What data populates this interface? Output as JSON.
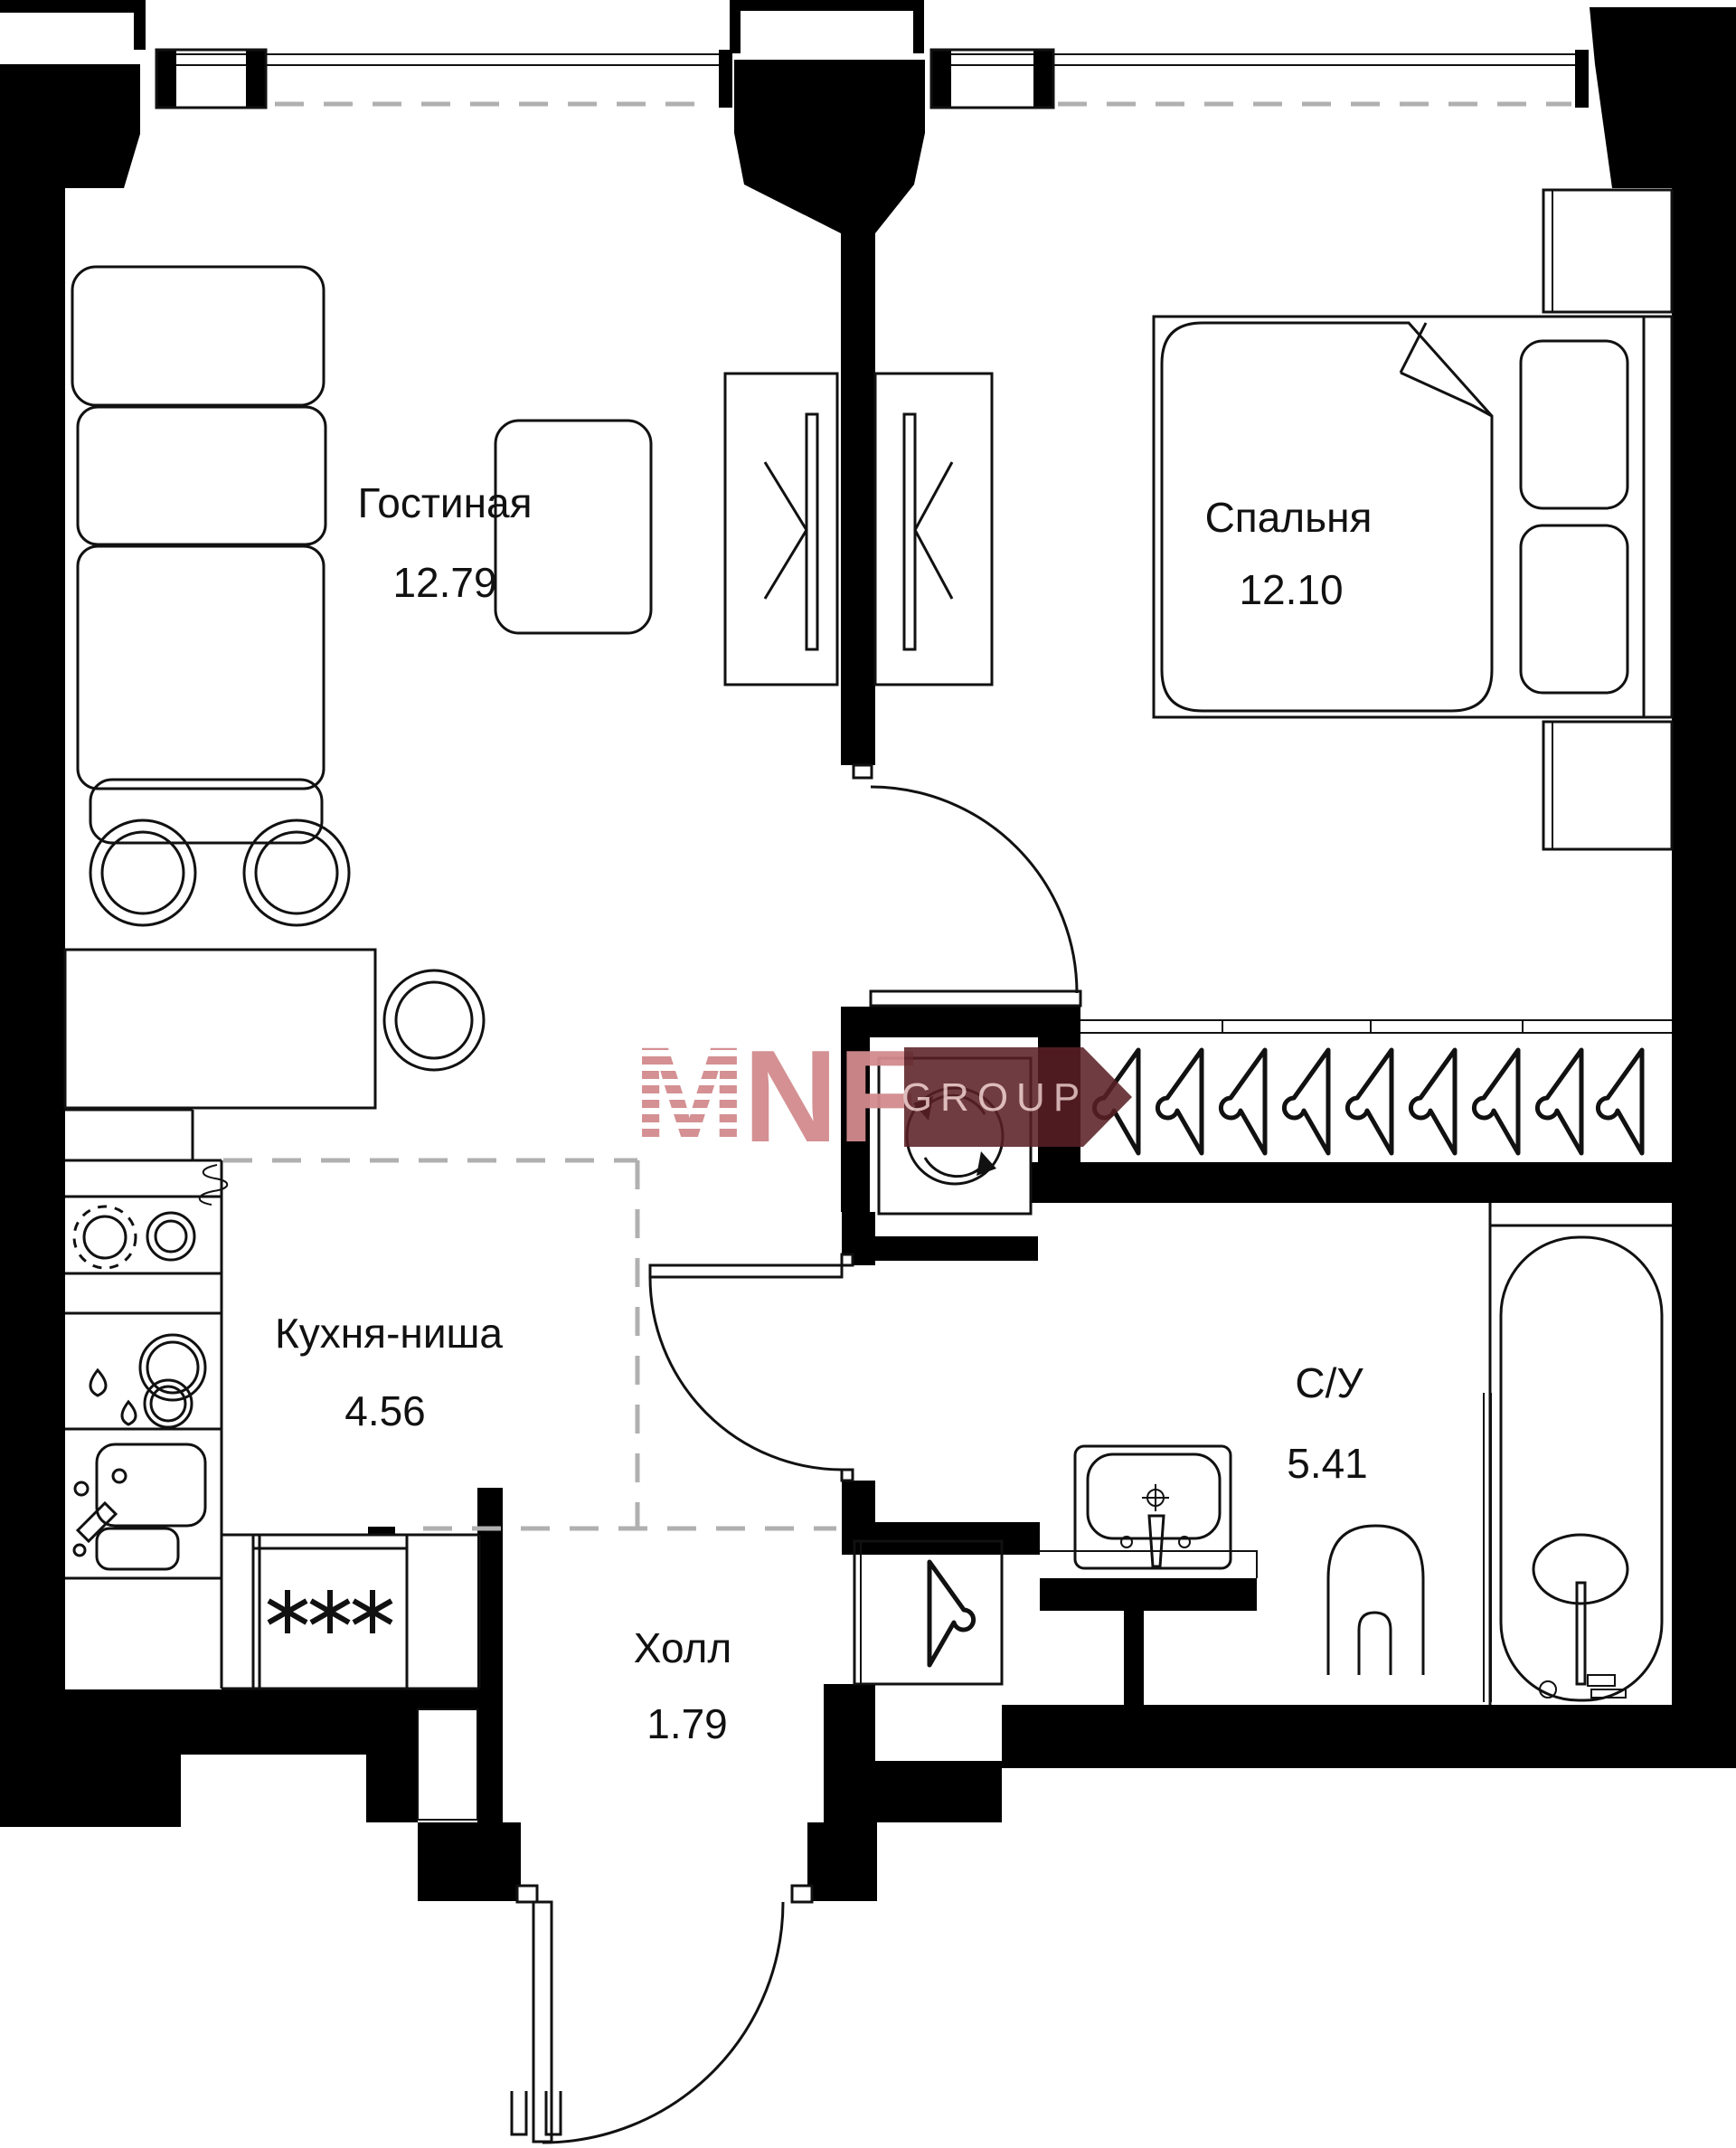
{
  "plan": {
    "rooms": [
      {
        "name": "Гостиная",
        "area": "12.79"
      },
      {
        "name": "Спальня",
        "area": "12.10"
      },
      {
        "name": "Кухня-ниша",
        "area": "4.56"
      },
      {
        "name": "С/У",
        "area": "5.41"
      },
      {
        "name": "Холл",
        "area": "1.79"
      }
    ],
    "watermark": {
      "logo_letter": "M",
      "brand": "NF",
      "suffix": "GROUP"
    },
    "freezer_symbol": "***",
    "colors": {
      "wall": "#000000",
      "line": "#111111",
      "dashed_boundary": "#b0b0b0",
      "watermark_pink": "#d28b8d",
      "watermark_banner": "#5a2125",
      "watermark_text": "#ddb9ba"
    }
  }
}
